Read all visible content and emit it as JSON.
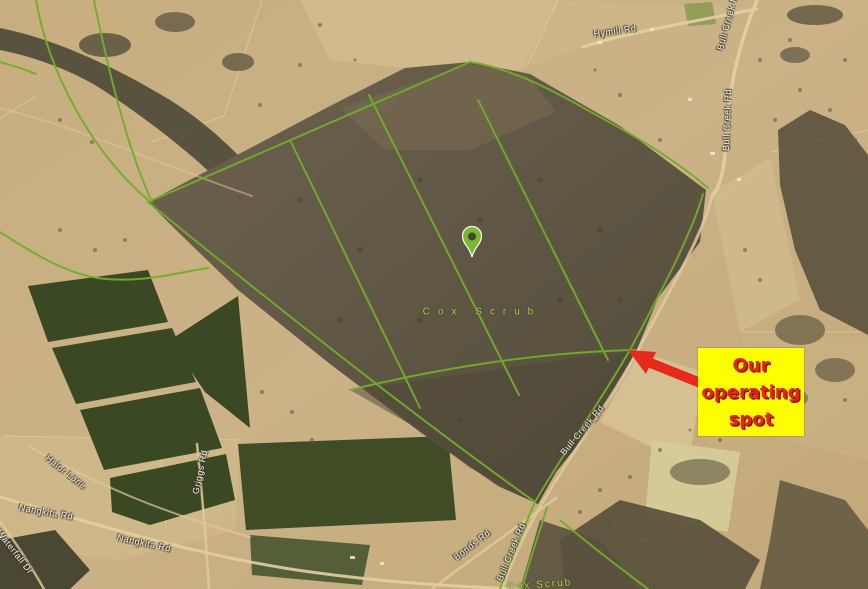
{
  "map": {
    "kind": "satellite-aerial-imagery",
    "road_labels": [
      {
        "text": "Hymill Rd",
        "x": 615,
        "y": 31,
        "rotate": -8
      },
      {
        "text": "Bull Creek Rd",
        "x": 728,
        "y": 20,
        "rotate": -75
      },
      {
        "text": "Bull Creek Rd",
        "x": 727,
        "y": 120,
        "rotate": -88
      },
      {
        "text": "Bull Creek Rd",
        "x": 582,
        "y": 430,
        "rotate": -50
      },
      {
        "text": "Bull Creek Rd",
        "x": 511,
        "y": 552,
        "rotate": -68
      },
      {
        "text": "Bonds Rd",
        "x": 472,
        "y": 545,
        "rotate": -38
      },
      {
        "text": "Nangkita Rd",
        "x": 46,
        "y": 512,
        "rotate": 10
      },
      {
        "text": "Nangkita Rd",
        "x": 144,
        "y": 543,
        "rotate": 12
      },
      {
        "text": "Griggs Rd",
        "x": 200,
        "y": 472,
        "rotate": -78
      },
      {
        "text": "Halor Lane",
        "x": 66,
        "y": 472,
        "rotate": 38
      },
      {
        "text": "Waterfall Dr",
        "x": 15,
        "y": 552,
        "rotate": 52
      }
    ],
    "park_labels": [
      {
        "text": "Cox Scrub",
        "x": 482,
        "y": 312,
        "rotate": 0,
        "spacing": 8
      },
      {
        "text": "Cox Scrub",
        "x": 540,
        "y": 585,
        "rotate": -4,
        "spacing": 2
      }
    ],
    "marker": {
      "name": "location-pin",
      "x": 472,
      "y": 257
    }
  },
  "annotation": {
    "lines": [
      "Our",
      "operating",
      "spot"
    ],
    "arrow_points_to": "trail junction on Bull Creek Rd at south-east edge of scrub"
  },
  "colors": {
    "annotation_yellow": "#fefe00",
    "annotation_red": "#e0251b",
    "arrow_red": "#e8291c",
    "pin_green": "#7db637",
    "trail_green": "#72ad2b",
    "road_label_white": "#f2efe6",
    "park_label_green": "#a6cf54"
  }
}
